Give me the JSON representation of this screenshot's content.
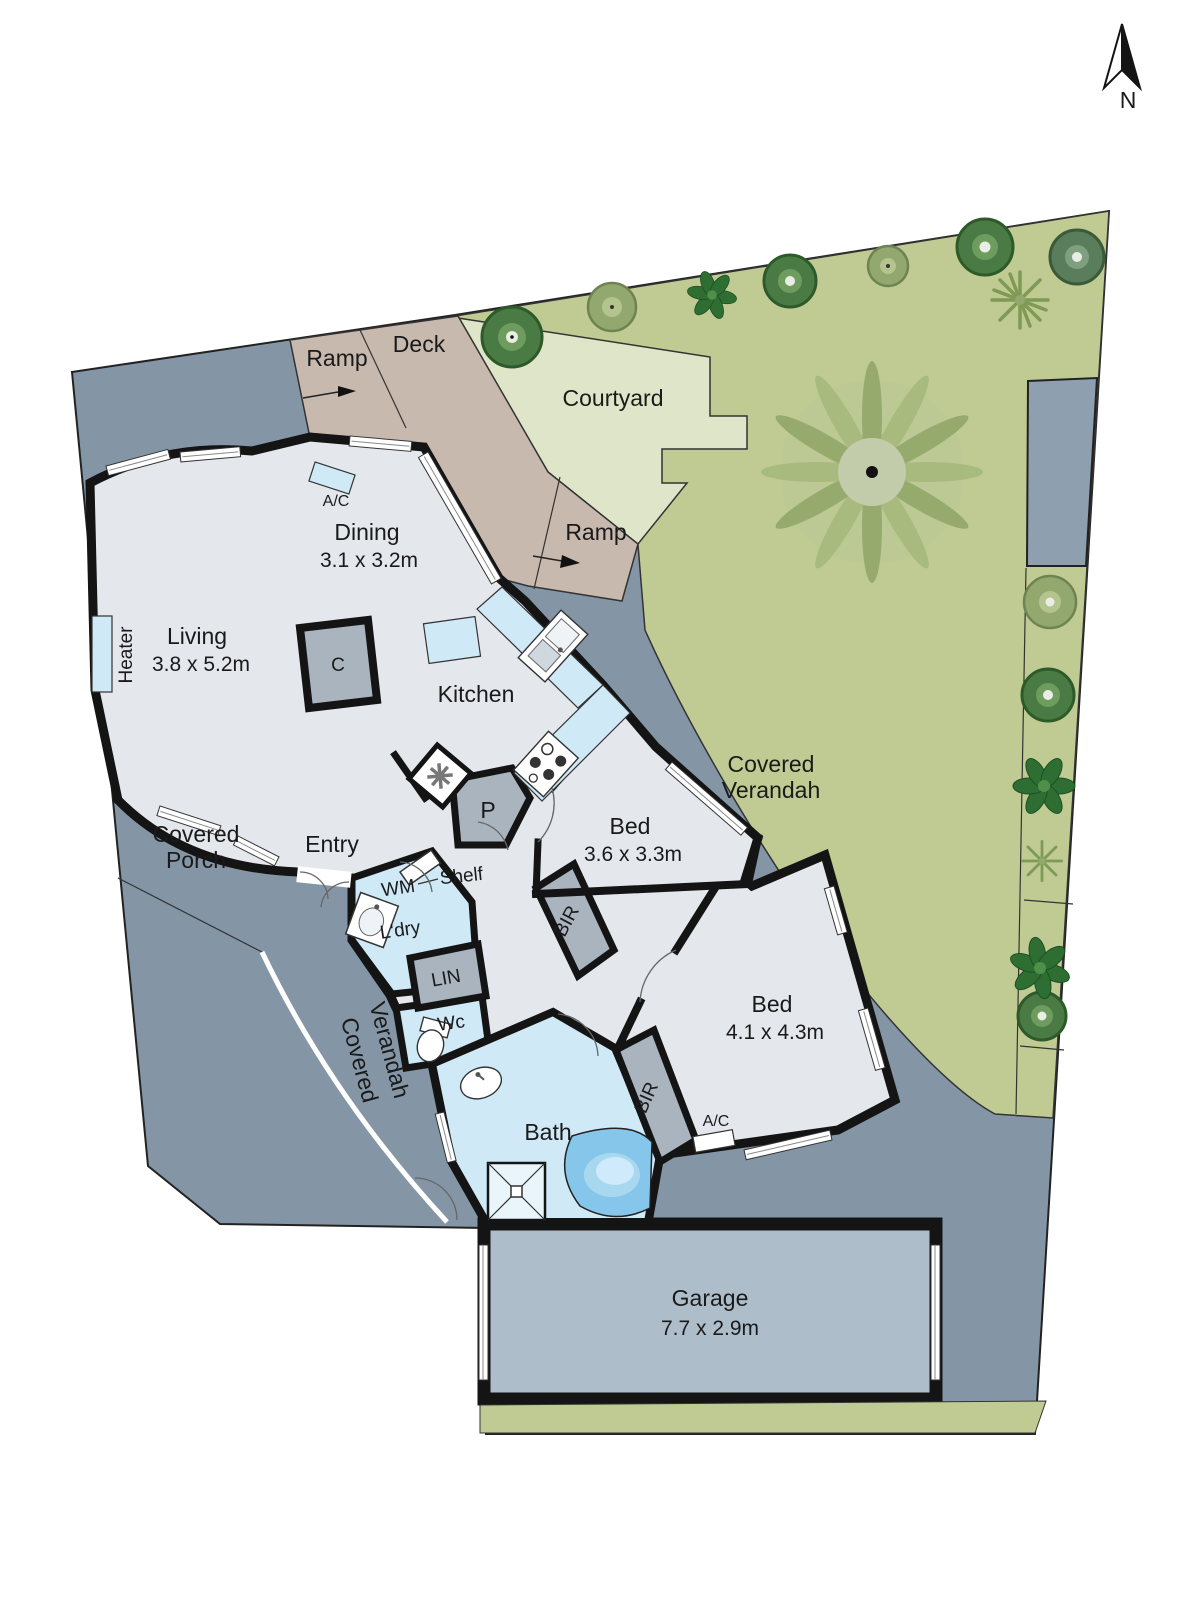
{
  "compass": {
    "n": "N"
  },
  "areas": {
    "ramp_top": "Ramp",
    "deck": "Deck",
    "courtyard": "Courtyard",
    "ramp_mid": "Ramp",
    "porch_l1": "Covered",
    "porch_l2": "Porch",
    "verandah_l1": "Covered",
    "verandah_l2": "Verandah"
  },
  "rooms": {
    "living": {
      "label": "Living",
      "dims": "3.8 x 5.2m"
    },
    "dining": {
      "label": "Dining",
      "dims": "3.1 x 3.2m"
    },
    "kitchen": {
      "label": "Kitchen"
    },
    "entry": {
      "label": "Entry"
    },
    "bed1": {
      "label": "Bed",
      "dims": "3.6 x 3.3m"
    },
    "bed2": {
      "label": "Bed",
      "dims": "4.1 x 4.3m"
    },
    "bath": {
      "label": "Bath"
    },
    "wc": {
      "label": "Wc"
    },
    "laundry": {
      "label": "L'dry"
    },
    "garage": {
      "label": "Garage",
      "dims": "7.7 x 2.9m"
    }
  },
  "fixtures": {
    "heater": "Heater",
    "wm": "WM",
    "lin": "LIN",
    "shelf": "Shelf",
    "cupboard": "C",
    "pantry": "P",
    "bir": "BIR",
    "ac": "A/C"
  },
  "colors": {
    "site_gray": "#8496A5",
    "lawn_green": "#BFCB92",
    "courtyard_green": "#DEE5C8",
    "deck_taupe": "#C7B9AE",
    "floor_gray": "#E4E7EC",
    "wet_blue": "#CFE9F7",
    "cabinet_gray": "#A9B4BE",
    "garage_gray": "#AEBDCA",
    "tub_blue": "#85C6EA",
    "wall_black": "#141414",
    "tree_dark": "#4A7B44",
    "tree_olive": "#93A86E"
  }
}
